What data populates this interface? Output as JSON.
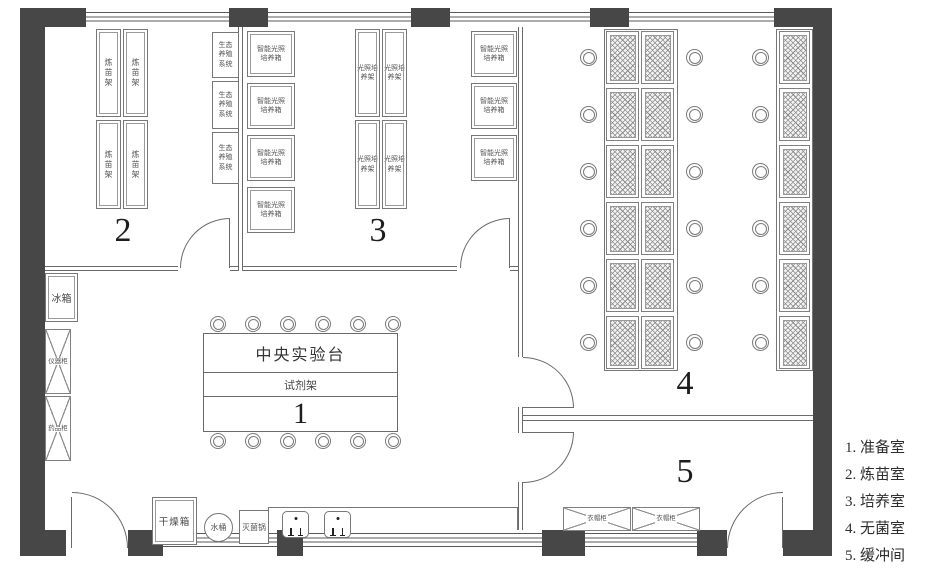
{
  "legend": {
    "items": [
      "1. 准备室",
      "2. 炼苗室",
      "3. 培养室",
      "4. 无菌室",
      "5. 缓冲间"
    ]
  },
  "rooms": {
    "r1": {
      "number": "1"
    },
    "r2": {
      "number": "2"
    },
    "r3": {
      "number": "3"
    },
    "r4": {
      "number": "4"
    },
    "r5": {
      "number": "5"
    }
  },
  "equipment": {
    "seedling_rack": "炼苗架",
    "eco_system": "生态养殖系统",
    "smart_incubator": "智能光照培养箱",
    "light_rack": "光照培养架",
    "fridge": "冰箱",
    "instrument_cabinet": "仪器柜",
    "medicine_cabinet": "药品柜",
    "central_bench": "中央实验台",
    "reagent_rack": "试剂架",
    "drying_oven": "干燥箱",
    "water_bucket": "水桶",
    "sterilizer": "灭菌锅",
    "locker": "衣帽柜"
  },
  "counts": {
    "seedling_racks": 4,
    "eco_systems": 3,
    "incubators_left": 4,
    "incubators_right": 3,
    "light_racks": 4,
    "stool_cols": 3,
    "stool_rows": 6,
    "clean_bench_mid_rows": 6,
    "clean_bench_mid_cols": 2,
    "clean_bench_right_rows": 6,
    "central_stools_per_side": 6,
    "sinks": 2,
    "lockers": 2
  },
  "colors": {
    "wall": "#474747",
    "line": "#6a6a6a"
  }
}
